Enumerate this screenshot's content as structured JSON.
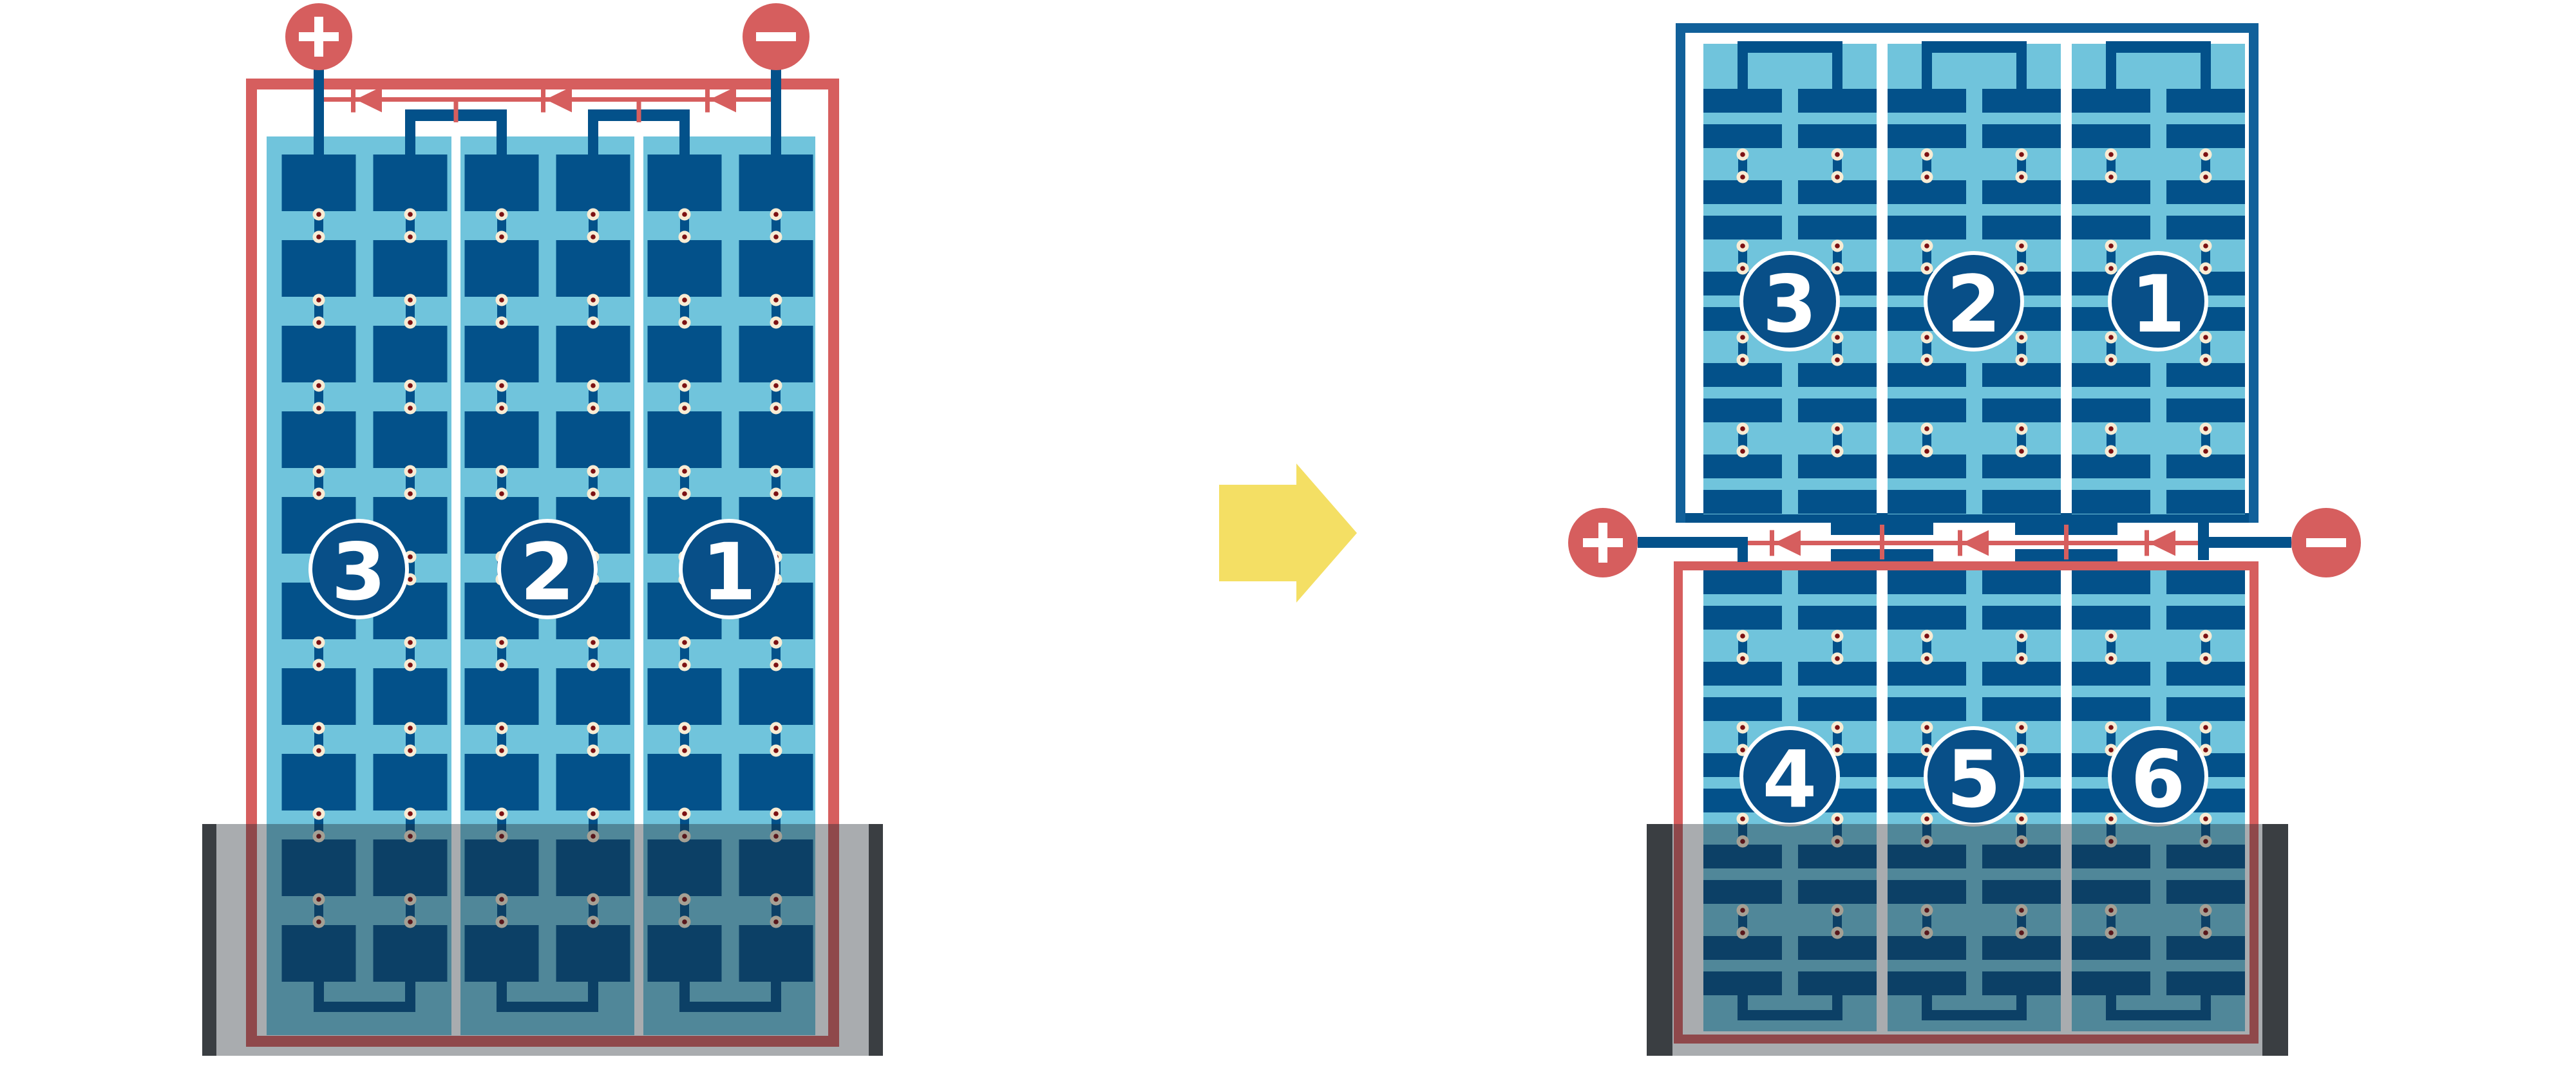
{
  "colors": {
    "red": "#D65E5E",
    "navy": "#03518A",
    "light_blue": "#70C4DC",
    "frame_blue": "#11609A",
    "badge_blue": "#084F88",
    "cream": "#F8ECD4",
    "dot_red": "#7C1012",
    "yellow": "#F4DF64",
    "shadow_bar": "#3A3E42",
    "shadow_overlay": "rgba(30,38,44,0.38)",
    "white": "#FFFFFF"
  },
  "icons": [
    "plus-icon",
    "minus-icon",
    "arrow-right-icon",
    "bypass-diode-icon"
  ],
  "left_module": {
    "terminals": {
      "positive": "+",
      "negative": "−"
    },
    "string_labels": [
      "3",
      "2",
      "1"
    ],
    "cell_rows": 10,
    "cell_columns_per_string": 2,
    "bypass_diodes": 3,
    "shaded": true
  },
  "right_module": {
    "terminals": {
      "positive": "+",
      "negative": "−"
    },
    "top_half_string_labels": [
      "3",
      "2",
      "1"
    ],
    "bottom_half_string_labels": [
      "4",
      "5",
      "6"
    ],
    "cell_row_pairs_per_half": 5,
    "cell_columns_per_string": 2,
    "bypass_diodes": 3,
    "shaded": true
  },
  "arrow": {
    "direction": "right"
  }
}
